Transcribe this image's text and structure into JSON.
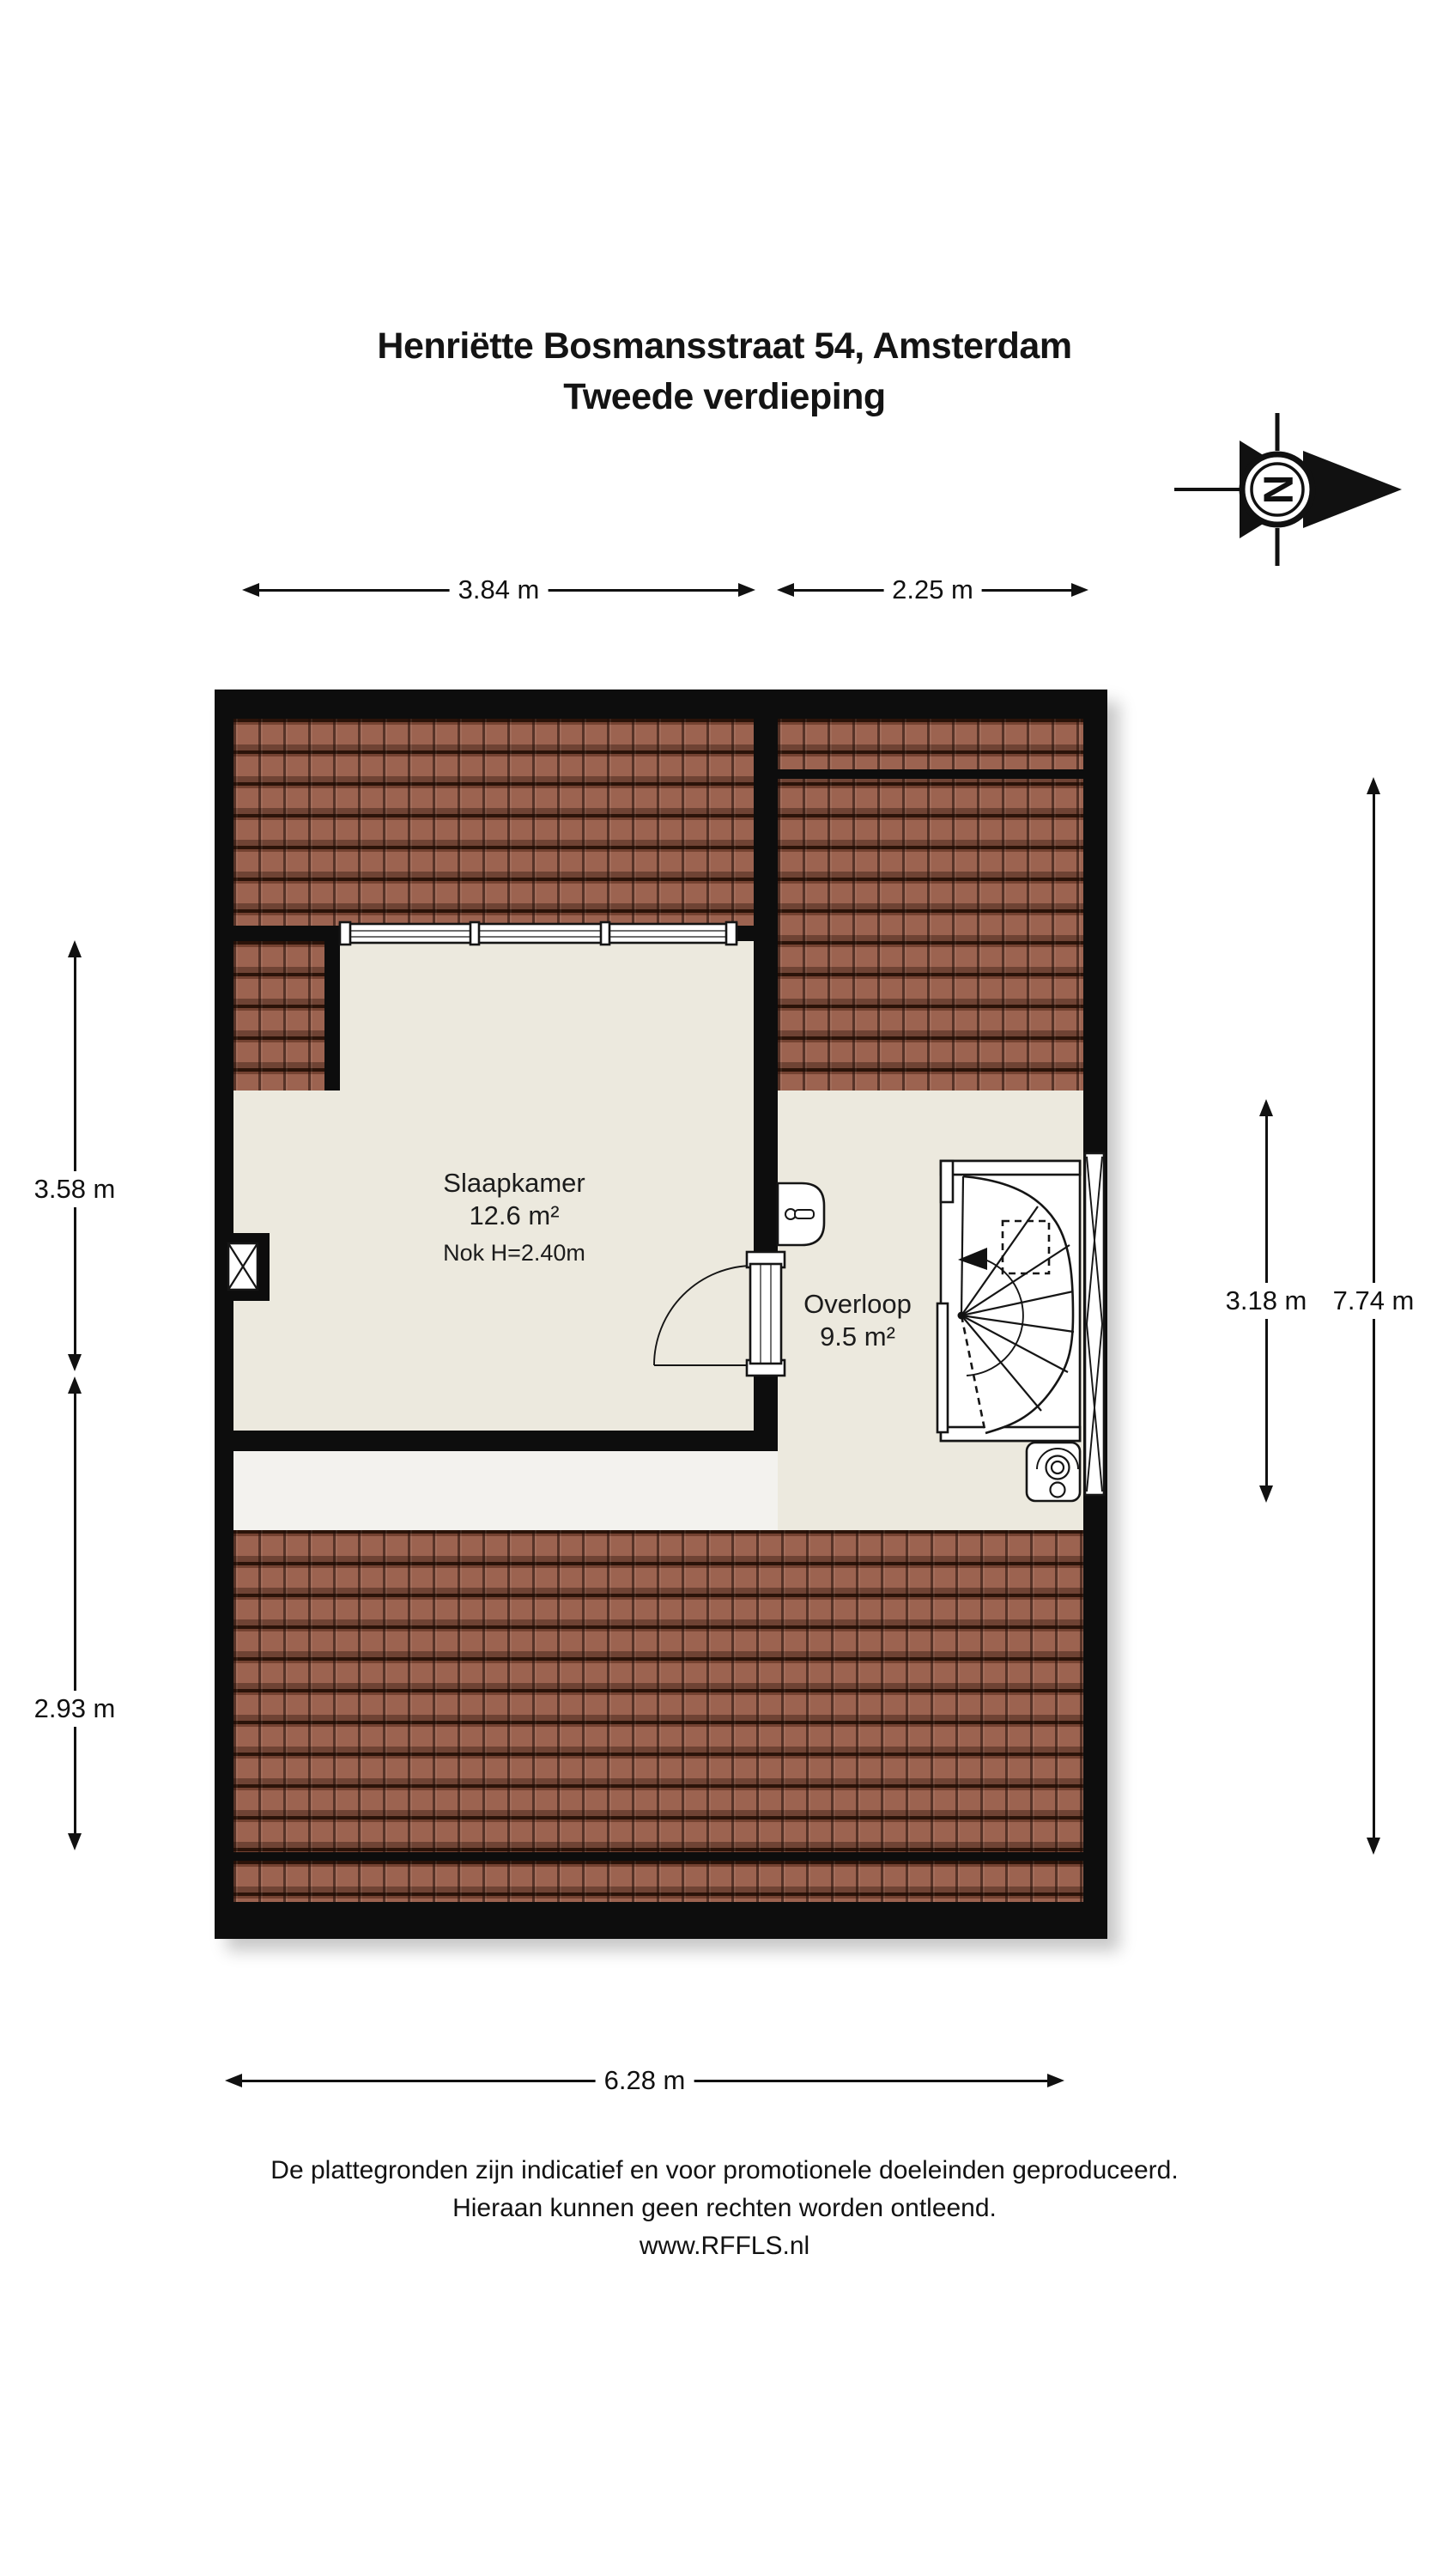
{
  "title": {
    "line1": "Henriëtte Bosmansstraat 54, Amsterdam",
    "line2": "Tweede verdieping"
  },
  "compass": {
    "letter": "N"
  },
  "dimensions": {
    "top_left": "3.84 m",
    "top_right": "2.25 m",
    "bottom": "6.28 m",
    "left_upper": "3.58 m",
    "left_lower": "2.93 m",
    "right_inner": "3.18 m",
    "right_outer": "7.74 m"
  },
  "rooms": {
    "slaapkamer": {
      "name": "Slaapkamer",
      "area": "12.6 m²",
      "note": "Nok H=2.40m"
    },
    "overloop": {
      "name": "Overloop",
      "area": "9.5 m²"
    }
  },
  "footer": {
    "line1": "De plattegronden zijn indicatief en voor promotionele doeleinden geproduceerd.",
    "line2": "Hieraan kunnen geen rechten worden ontleend.",
    "line3": "www.RFFLS.nl"
  },
  "colors": {
    "wall": "#0d0d0d",
    "roof_tile": "#9c6350",
    "roof_gap": "#2b1309",
    "floor": "#ece9de",
    "floor_light": "#f3f2ee",
    "background": "#ffffff"
  }
}
